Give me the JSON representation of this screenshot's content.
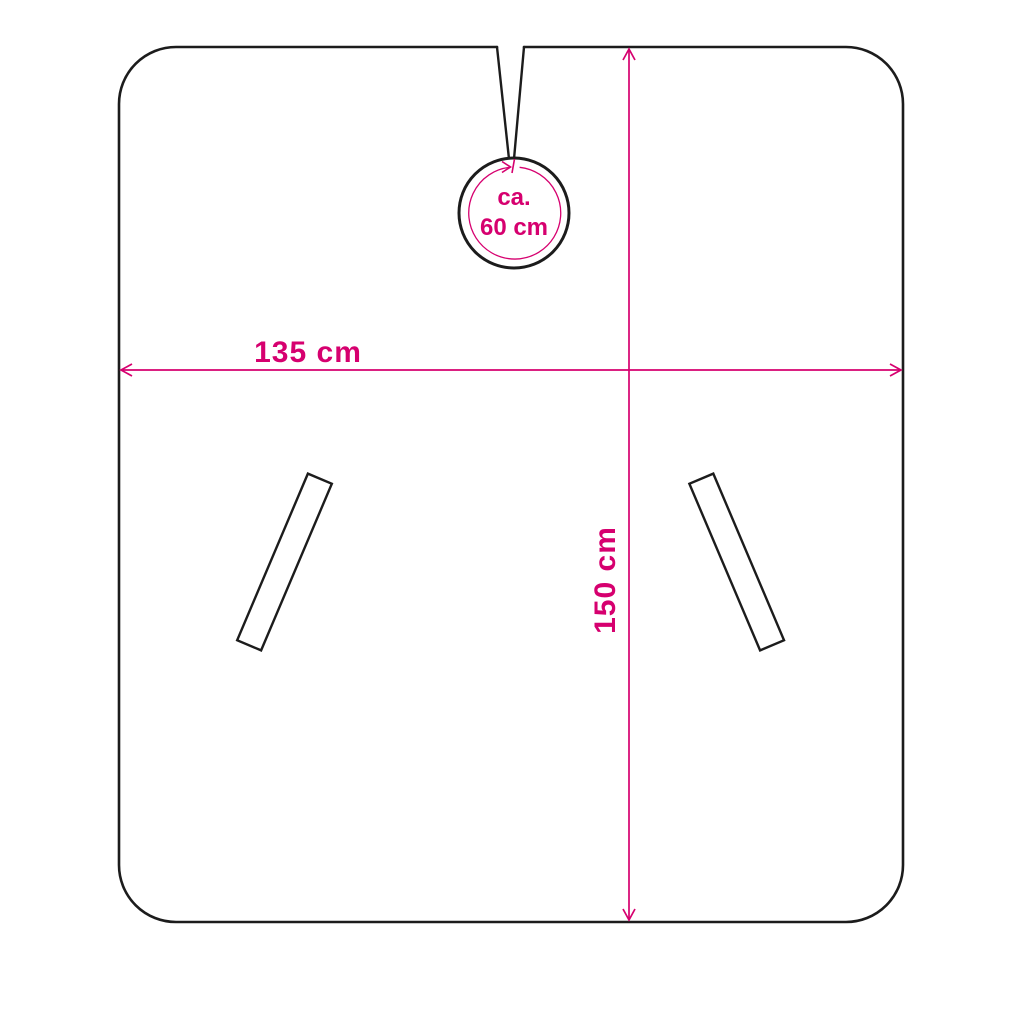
{
  "diagram": {
    "type": "product-dimension-diagram",
    "subject": "cape-outline-with-neck-opening-and-hand-slits",
    "labels": {
      "width_label": "135 cm",
      "height_label": "150 cm",
      "neck_approx": "ca.",
      "neck_size": "60 cm"
    },
    "measurements": {
      "width_cm": 135,
      "height_cm": 150,
      "neck_circumference_cm": 60,
      "neck_is_approximate": true
    },
    "colors": {
      "outline": "#1c1c1c",
      "dimension": "#d6006f",
      "background": "#ffffff"
    }
  }
}
